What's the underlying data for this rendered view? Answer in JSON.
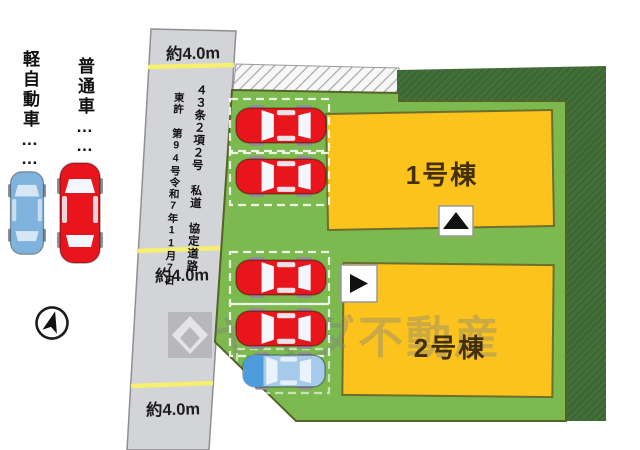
{
  "legend": {
    "items": [
      {
        "label": "軽自動車",
        "leader": "……",
        "car_color": "#7fb2dd"
      },
      {
        "label": "普通車",
        "leader": "……",
        "car_color": "#e8151d"
      }
    ]
  },
  "road": {
    "width_labels": {
      "top": "約4.0m",
      "middle": "約4.0m",
      "bottom": "約4.0m"
    },
    "designation": "４３条２項２号 私道 協定道路",
    "permit": "東許 第94号令和7年11月7日"
  },
  "site": {
    "buildings": [
      {
        "label": "1号棟",
        "entrance_arrow": "up"
      },
      {
        "label": "2号棟",
        "entrance_arrow": "right"
      }
    ],
    "parking": {
      "upper_red_cars": 2,
      "lower_red_cars": 2,
      "lower_light_cars": 1
    }
  },
  "watermark": {
    "text": "ヤマダ不動産"
  },
  "colors": {
    "plot_green": "#7cb94e",
    "plot_border": "#55622a",
    "boundary_dark_green": "#426f38",
    "building_yellow": "#fbc31c",
    "building_border": "#6e6e2d",
    "road_gray": "#d3d4d7",
    "lane_yellow": "#f6ef6f",
    "car_red": "#e8151d",
    "car_blue_light": "#a6cbea",
    "car_blue": "#7fb2dd"
  }
}
